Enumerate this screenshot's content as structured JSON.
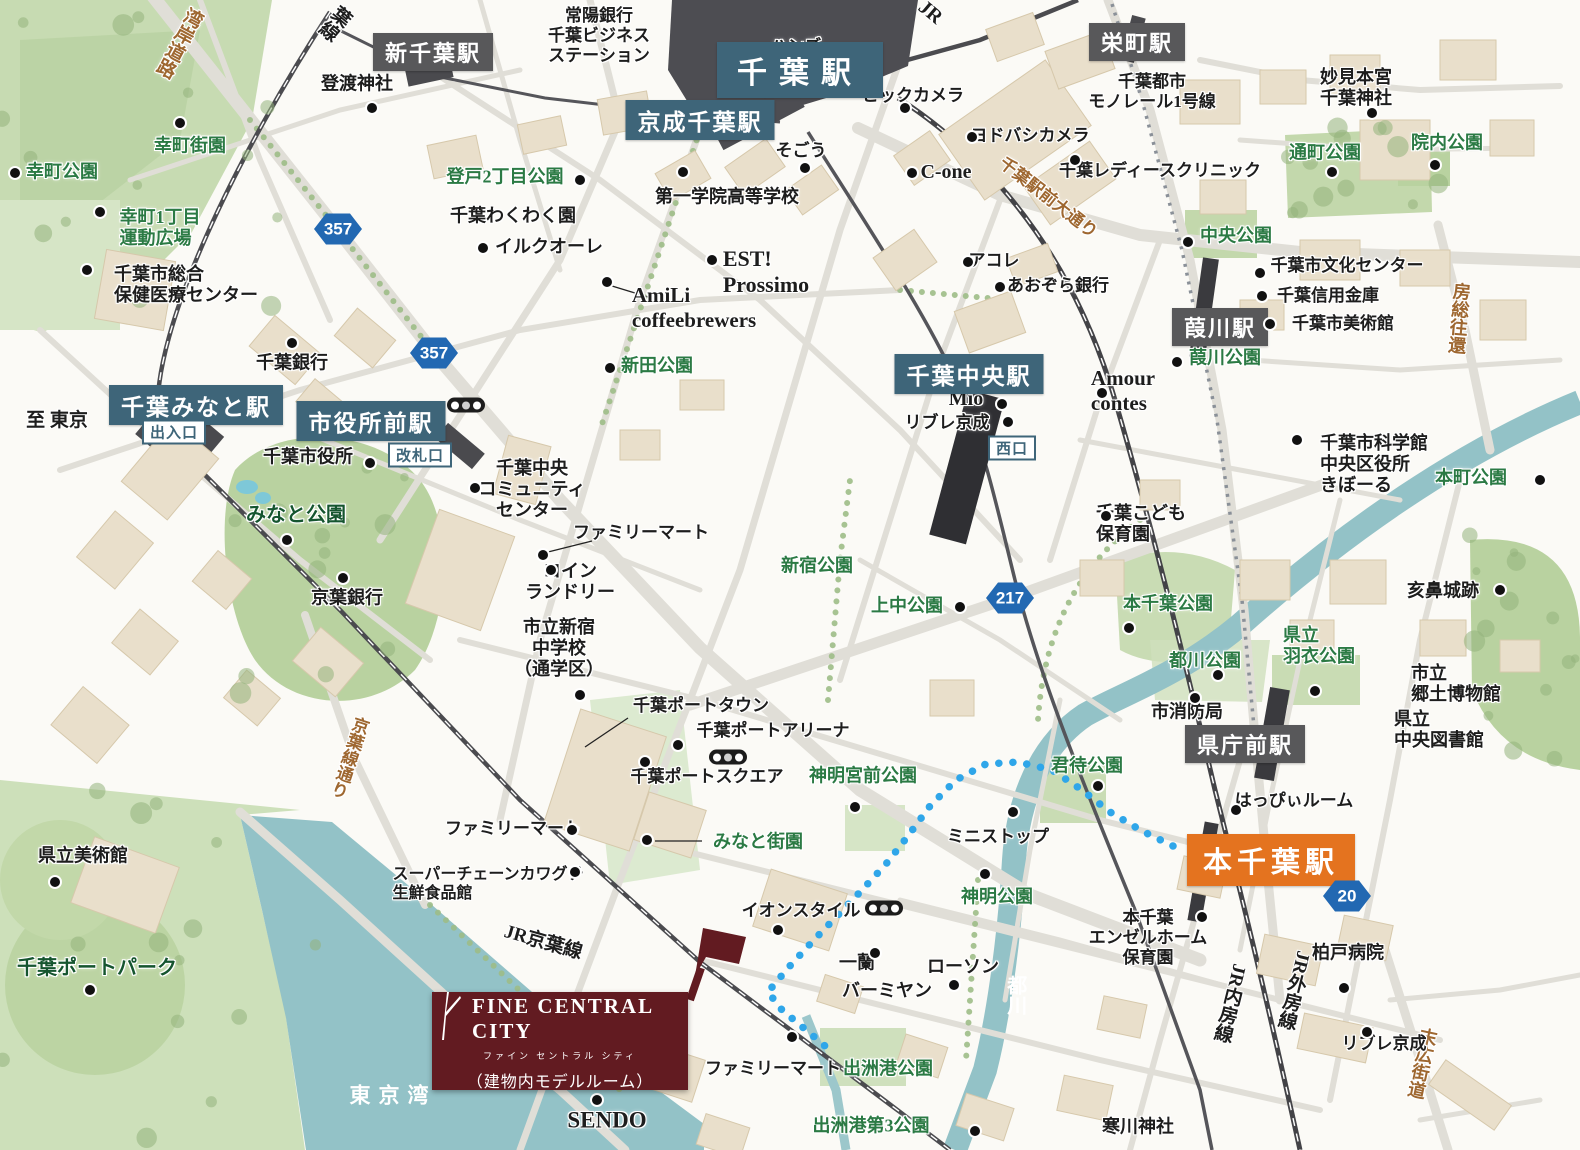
{
  "map": {
    "colors": {
      "station_blue": "#3e6579",
      "station_gray": "#58585a",
      "station_orange": "#e4731f",
      "park_text": "#2b7a44",
      "road_text": "#9e6730",
      "water": "#93c2c7",
      "route_blue": "#2fa6e9",
      "brand_maroon": "#621b21",
      "shield_blue": "#2268b2"
    },
    "logo": {
      "brand": "FINE CENTRAL CITY",
      "kana": "ファイン セントラル シティ",
      "note": "（建物内モデルルーム）"
    },
    "stations": [
      {
        "t": "千葉駅",
        "x": 800,
        "y": 70,
        "st": "blue",
        "s": 30,
        "ls": 12,
        "px": 20,
        "py": 6
      },
      {
        "t": "京成千葉駅",
        "x": 700,
        "y": 120,
        "st": "blue",
        "s": 23
      },
      {
        "t": "千葉みなと駅",
        "x": 196,
        "y": 405,
        "st": "blue",
        "s": 23
      },
      {
        "t": "市役所前駅",
        "x": 371,
        "y": 421,
        "st": "blue",
        "s": 23
      },
      {
        "t": "千葉中央駅",
        "x": 969,
        "y": 374,
        "st": "blue",
        "s": 23
      },
      {
        "t": "新千葉駅",
        "x": 433,
        "y": 52,
        "st": "gray",
        "s": 22
      },
      {
        "t": "栄町駅",
        "x": 1137,
        "y": 42,
        "st": "gray",
        "s": 22
      },
      {
        "t": "葭川駅",
        "x": 1220,
        "y": 327,
        "st": "gray",
        "s": 22
      },
      {
        "t": "県庁前駅",
        "x": 1245,
        "y": 744,
        "st": "gray",
        "s": 22
      },
      {
        "t": "本千葉駅",
        "x": 1271,
        "y": 860,
        "st": "orange",
        "s": 29,
        "ls": 5,
        "px": 16,
        "py": 5
      },
      {
        "t": "出入口",
        "x": 174,
        "y": 432,
        "st": "outline"
      },
      {
        "t": "改札口",
        "x": 420,
        "y": 455,
        "st": "outline"
      },
      {
        "t": "西口",
        "x": 1012,
        "y": 448,
        "st": "outline"
      }
    ],
    "shields": [
      {
        "n": "357",
        "x": 338,
        "y": 229
      },
      {
        "n": "357",
        "x": 434,
        "y": 353
      },
      {
        "n": "217",
        "x": 1010,
        "y": 598
      },
      {
        "n": "20",
        "x": 1347,
        "y": 896
      }
    ],
    "traffic_lights": [
      [
        466,
        405
      ],
      [
        728,
        757
      ],
      [
        884,
        908
      ]
    ],
    "labels": [
      {
        "t": "湾岸道路",
        "x": 178,
        "y": 42,
        "c": "road",
        "v": 1,
        "r": 28,
        "s": 19
      },
      {
        "t": "葉線",
        "x": 334,
        "y": 22,
        "v": 1,
        "r": 40,
        "s": 19
      },
      {
        "t": "JR",
        "x": 930,
        "y": 13,
        "r": 40,
        "s": 20
      },
      {
        "t": "常陽銀行\n千葉ビジネス\nステーション",
        "x": 599,
        "y": 36,
        "s": 17
      },
      {
        "t": "ハンズ",
        "x": 796,
        "y": 47,
        "s": 17
      },
      {
        "t": "登渡神社",
        "x": 357,
        "y": 84
      },
      {
        "t": "千葉都市\nモノレール1号線",
        "x": 1152,
        "y": 92,
        "s": 17
      },
      {
        "t": "妙見本宮\n千葉神社",
        "x": 1356,
        "y": 88
      },
      {
        "t": "ビックカメラ",
        "x": 913,
        "y": 96,
        "s": 17
      },
      {
        "t": "ヨドバシカメラ",
        "x": 1030,
        "y": 136,
        "s": 17
      },
      {
        "t": "そごう",
        "x": 801,
        "y": 151,
        "s": 17
      },
      {
        "t": "C-one",
        "x": 946,
        "y": 173,
        "s": 20
      },
      {
        "t": "千葉駅前大通り",
        "x": 1048,
        "y": 198,
        "c": "road",
        "r": 38,
        "s": 17
      },
      {
        "t": "千葉レディースクリニック",
        "x": 1160,
        "y": 171,
        "s": 17
      },
      {
        "t": "通町公園",
        "x": 1325,
        "y": 153,
        "c": "park"
      },
      {
        "t": "院内公園",
        "x": 1447,
        "y": 143,
        "c": "park"
      },
      {
        "t": "幸町街園",
        "x": 190,
        "y": 146,
        "c": "park"
      },
      {
        "t": "幸町公園",
        "x": 62,
        "y": 172,
        "c": "park"
      },
      {
        "t": "幸町1丁目\n運動広場",
        "x": 160,
        "y": 228,
        "c": "park",
        "a": "l"
      },
      {
        "t": "登戸2丁目公園",
        "x": 505,
        "y": 177,
        "c": "park"
      },
      {
        "t": "千葉わくわく園",
        "x": 513,
        "y": 216
      },
      {
        "t": "イルクオーレ",
        "x": 549,
        "y": 247
      },
      {
        "t": "第一学院高等学校",
        "x": 727,
        "y": 197
      },
      {
        "t": "EST!\nProssimo",
        "x": 766,
        "y": 272,
        "s": 22,
        "a": "l"
      },
      {
        "t": "AmiLi\ncoffeebrewers",
        "x": 694,
        "y": 308,
        "s": 21,
        "a": "l"
      },
      {
        "t": "中央公園",
        "x": 1236,
        "y": 236,
        "c": "park"
      },
      {
        "t": "千葉市文化センター",
        "x": 1347,
        "y": 266,
        "s": 17
      },
      {
        "t": "千葉信用金庫",
        "x": 1328,
        "y": 296,
        "s": 17
      },
      {
        "t": "千葉市美術館",
        "x": 1343,
        "y": 324,
        "s": 17
      },
      {
        "t": "房総往還",
        "x": 1458,
        "y": 318,
        "c": "road",
        "v": 1,
        "r": 5,
        "s": 18
      },
      {
        "t": "千葉銀行",
        "x": 292,
        "y": 363
      },
      {
        "t": "新田公園",
        "x": 657,
        "y": 366,
        "c": "park"
      },
      {
        "t": "Mio",
        "x": 966,
        "y": 400,
        "s": 20
      },
      {
        "t": "リブレ京成",
        "x": 947,
        "y": 423,
        "s": 17
      },
      {
        "t": "Amour\ncontes",
        "x": 1123,
        "y": 391,
        "s": 21,
        "a": "l"
      },
      {
        "t": "葭川公園",
        "x": 1225,
        "y": 358,
        "c": "park"
      },
      {
        "t": "至 東京",
        "x": 57,
        "y": 421,
        "s": 19
      },
      {
        "t": "千葉市役所",
        "x": 308,
        "y": 457
      },
      {
        "t": "みなと公園",
        "x": 296,
        "y": 516,
        "c": "parkx"
      },
      {
        "t": "千葉中央\nコミュニティ\nセンター",
        "x": 532,
        "y": 490
      },
      {
        "t": "ファミリーマート",
        "x": 641,
        "y": 533,
        "s": 17
      },
      {
        "t": "コイン\nランドリー",
        "x": 570,
        "y": 582
      },
      {
        "t": "京葉銀行",
        "x": 347,
        "y": 598
      },
      {
        "t": "新宿公園",
        "x": 817,
        "y": 566,
        "c": "park"
      },
      {
        "t": "上中公園",
        "x": 907,
        "y": 606,
        "c": "park"
      },
      {
        "t": "千葉こども\n保育園",
        "x": 1141,
        "y": 524,
        "a": "l"
      },
      {
        "t": "本千葉公園",
        "x": 1168,
        "y": 604,
        "c": "park"
      },
      {
        "t": "千葉市科学館\n中央区役所\nきぼーる",
        "x": 1374,
        "y": 465,
        "a": "l"
      },
      {
        "t": "本町公園",
        "x": 1471,
        "y": 478,
        "c": "park"
      },
      {
        "t": "都川公園",
        "x": 1205,
        "y": 661,
        "c": "park"
      },
      {
        "t": "県立\n羽衣公園",
        "x": 1319,
        "y": 646,
        "c": "park",
        "a": "l"
      },
      {
        "t": "亥鼻城跡",
        "x": 1443,
        "y": 591
      },
      {
        "t": "市立\n郷土博物館",
        "x": 1456,
        "y": 684,
        "a": "l"
      },
      {
        "t": "県立\n中央図書館",
        "x": 1439,
        "y": 730,
        "a": "l"
      },
      {
        "t": "市消防局",
        "x": 1187,
        "y": 712
      },
      {
        "t": "市立新宿\n中学校\n（通学区）",
        "x": 559,
        "y": 649
      },
      {
        "t": "千葉ポートタウン",
        "x": 701,
        "y": 706,
        "s": 17
      },
      {
        "t": "千葉ポートアリーナ",
        "x": 773,
        "y": 731,
        "s": 17
      },
      {
        "t": "千葉ポートスクエア",
        "x": 707,
        "y": 777,
        "s": 17
      },
      {
        "t": "神明宮前公園",
        "x": 863,
        "y": 776,
        "c": "park"
      },
      {
        "t": "君待公園",
        "x": 1087,
        "y": 766,
        "c": "park"
      },
      {
        "t": "はっぴぃルーム",
        "x": 1294,
        "y": 801,
        "s": 17
      },
      {
        "t": "みなと街園",
        "x": 758,
        "y": 842,
        "c": "park"
      },
      {
        "t": "ファミリーマート",
        "x": 513,
        "y": 829,
        "s": 17
      },
      {
        "t": "ミニストップ",
        "x": 998,
        "y": 837,
        "s": 17
      },
      {
        "t": "スーパーチェーンカワグチ\n生鮮食品館",
        "x": 488,
        "y": 885,
        "s": 16,
        "a": "l"
      },
      {
        "t": "県立美術館",
        "x": 83,
        "y": 856
      },
      {
        "t": "神明公園",
        "x": 997,
        "y": 897,
        "c": "park"
      },
      {
        "t": "イオンスタイル",
        "x": 801,
        "y": 911,
        "s": 17
      },
      {
        "t": "本千葉\nエンゼルホーム\n保育園",
        "x": 1148,
        "y": 938,
        "s": 17
      },
      {
        "t": "柏戸病院",
        "x": 1348,
        "y": 953
      },
      {
        "t": "千葉ポートパーク",
        "x": 97,
        "y": 969,
        "c": "parkx"
      },
      {
        "t": "一蘭",
        "x": 857,
        "y": 963
      },
      {
        "t": "バーミヤン",
        "x": 887,
        "y": 991
      },
      {
        "t": "ローソン",
        "x": 963,
        "y": 967
      },
      {
        "t": "都川",
        "x": 1014,
        "y": 995,
        "c": "water",
        "v": 1,
        "s": 20
      },
      {
        "t": "JR内房線",
        "x": 1229,
        "y": 1003,
        "v": 1,
        "r": 14,
        "s": 19
      },
      {
        "t": "JR外房線",
        "x": 1293,
        "y": 990,
        "v": 1,
        "r": 14,
        "s": 19
      },
      {
        "t": "末広街道",
        "x": 1421,
        "y": 1063,
        "c": "road",
        "v": 1,
        "r": 12,
        "s": 18
      },
      {
        "t": "リブレ京成",
        "x": 1384,
        "y": 1044,
        "s": 17
      },
      {
        "t": "寒川神社",
        "x": 1138,
        "y": 1127
      },
      {
        "t": "SENDO",
        "x": 607,
        "y": 1120,
        "s": 23
      },
      {
        "t": "ファミリーマート",
        "x": 773,
        "y": 1069,
        "s": 17
      },
      {
        "t": "出洲港公園",
        "x": 888,
        "y": 1069,
        "c": "park"
      },
      {
        "t": "出洲港第3公園",
        "x": 871,
        "y": 1126,
        "c": "park"
      },
      {
        "t": "東京湾",
        "x": 393,
        "y": 1096,
        "c": "water",
        "s": 21,
        "ls": 8
      },
      {
        "t": "JR京葉線",
        "x": 543,
        "y": 943,
        "r": 16,
        "s": 19
      },
      {
        "t": "京葉線通り",
        "x": 348,
        "y": 757,
        "c": "road",
        "v": 1,
        "r": 18,
        "s": 17
      },
      {
        "t": "千葉市総合\n保健医療センター",
        "x": 186,
        "y": 285,
        "a": "l"
      },
      {
        "t": "あおぞら銀行",
        "x": 1058,
        "y": 286,
        "s": 17
      },
      {
        "t": "アコレ",
        "x": 994,
        "y": 261,
        "s": 17
      }
    ],
    "poi_dots": [
      [
        180,
        123
      ],
      [
        15,
        173
      ],
      [
        100,
        212
      ],
      [
        87,
        270
      ],
      [
        372,
        108
      ],
      [
        580,
        180
      ],
      [
        483,
        248
      ],
      [
        712,
        260
      ],
      [
        607,
        282
      ],
      [
        683,
        172
      ],
      [
        805,
        168
      ],
      [
        905,
        108
      ],
      [
        972,
        137
      ],
      [
        912,
        173
      ],
      [
        1075,
        160
      ],
      [
        968,
        262
      ],
      [
        1000,
        287
      ],
      [
        1188,
        242
      ],
      [
        1260,
        273
      ],
      [
        1262,
        296
      ],
      [
        1270,
        324
      ],
      [
        1332,
        172
      ],
      [
        1435,
        165
      ],
      [
        1372,
        113
      ],
      [
        292,
        343
      ],
      [
        370,
        463
      ],
      [
        287,
        540
      ],
      [
        475,
        488
      ],
      [
        543,
        555
      ],
      [
        551,
        570
      ],
      [
        343,
        578
      ],
      [
        610,
        368
      ],
      [
        960,
        607
      ],
      [
        1002,
        404
      ],
      [
        1008,
        422
      ],
      [
        1102,
        393
      ],
      [
        1177,
        362
      ],
      [
        1106,
        516
      ],
      [
        1297,
        440
      ],
      [
        1540,
        480
      ],
      [
        1500,
        590
      ],
      [
        1129,
        628
      ],
      [
        1218,
        675
      ],
      [
        1315,
        691
      ],
      [
        1195,
        698
      ],
      [
        1098,
        786
      ],
      [
        855,
        807
      ],
      [
        1236,
        810
      ],
      [
        1013,
        812
      ],
      [
        572,
        830
      ],
      [
        647,
        840
      ],
      [
        575,
        872
      ],
      [
        985,
        874
      ],
      [
        778,
        930
      ],
      [
        875,
        953
      ],
      [
        954,
        985
      ],
      [
        792,
        1037
      ],
      [
        1344,
        988
      ],
      [
        1367,
        1032
      ],
      [
        1202,
        917
      ],
      [
        678,
        745
      ],
      [
        645,
        762
      ],
      [
        580,
        695
      ],
      [
        55,
        882
      ],
      [
        90,
        990
      ],
      [
        597,
        1100
      ],
      [
        975,
        1131
      ]
    ],
    "route_points": [
      [
        1173,
        846
      ],
      [
        1142,
        831
      ],
      [
        1110,
        812
      ],
      [
        1082,
        790
      ],
      [
        1052,
        770
      ],
      [
        1018,
        762
      ],
      [
        986,
        764
      ],
      [
        956,
        780
      ],
      [
        930,
        806
      ],
      [
        908,
        836
      ],
      [
        886,
        864
      ],
      [
        862,
        890
      ],
      [
        838,
        915
      ],
      [
        812,
        942
      ],
      [
        788,
        968
      ],
      [
        768,
        992
      ],
      [
        782,
        1010
      ],
      [
        800,
        1025
      ],
      [
        818,
        1040
      ],
      [
        832,
        1052
      ]
    ]
  }
}
